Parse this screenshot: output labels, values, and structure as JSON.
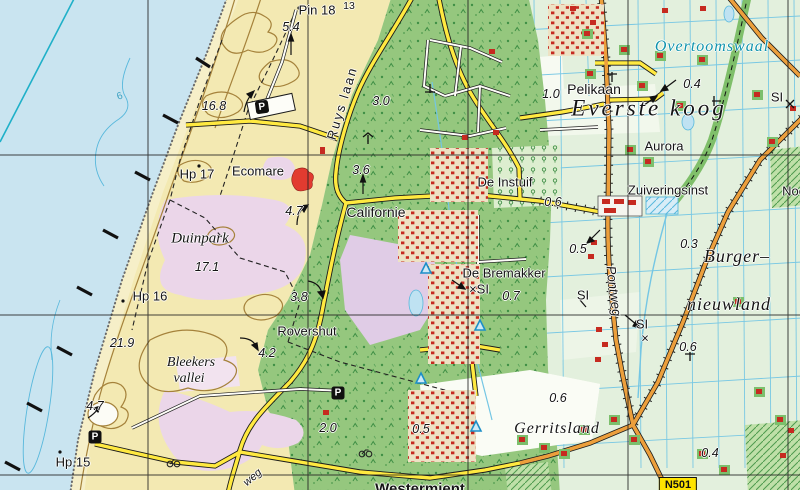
{
  "map": {
    "labels": {
      "pin18": "Pin 18",
      "sup13": "13",
      "h54": "5.4",
      "overtoomswaal": "Overtoomswaal",
      "pelikaan": "Pelikaan",
      "h10": "1.0",
      "everste_koog": "Everste koog",
      "aurora": "Aurora",
      "si_a": "SI",
      "h168": "16.8",
      "ruyslaan": "Ruys laan",
      "h30": "3.0",
      "h04_b": "0.4",
      "hp17": "Hp 17",
      "ecomare": "Ecomare",
      "de_instuif": "De Instuif",
      "zuiveringsinst": "Zuiveringsinst",
      "noo": "Noo",
      "h06_a": "0.6",
      "californie": "Californie",
      "h47_a": "4.7",
      "h36": "3.6",
      "duinpark": "Duinpark",
      "h05_a": "0.5",
      "h03": "0.3",
      "burger": "Burger–",
      "nieuwland": "nieuwland",
      "h171": "17.1",
      "de_bremakker": "De Bremakker",
      "xsi": "×SI",
      "h07": "0.7",
      "pontweg": "Pontweg",
      "si_b": "SI",
      "hp16": "Hp 16",
      "h38": "3.8",
      "si_c": "SI",
      "x_c": "×",
      "h06_b": "0.6",
      "rovershut": "Rovershut",
      "h219": "21.9",
      "h42": "4.2",
      "bleekers": "Bleekers",
      "vallei": "vallei",
      "h06_c": "0.6",
      "h47_b": "4.7",
      "h20": "2.0",
      "h05_b": "0.5",
      "gerritsland": "Gerritsland",
      "h04_a": "0.4",
      "hp15": "Hp 15",
      "westermient": "Westermient",
      "weg": "weg",
      "depth6": "6"
    },
    "icons": {
      "parking": "P"
    },
    "road_shield": "N501",
    "colors": {
      "sea": "#C9E4F0",
      "sand": "#F3E9B2",
      "beach": "#F6EFC8",
      "forest": "#95C77E",
      "fields": "#E3F0DD",
      "heath": "#EBD6E9",
      "contour_brown": "#A5823B",
      "road_yellow": "#FFE940",
      "road_orange": "#EC9F3C",
      "building_red": "#C62A20",
      "ditch_blue": "#74C6E4",
      "water_label": "#0E93AC"
    }
  }
}
